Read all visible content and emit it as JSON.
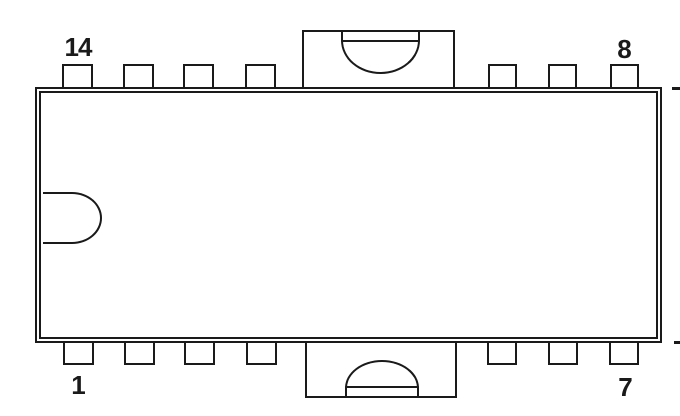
{
  "diagram": {
    "type": "ic-package-pinout",
    "description": "14-pin dual in-line package (DIP), top view",
    "pin_labels": {
      "top_left": "14",
      "top_right": "8",
      "bottom_left": "1",
      "bottom_right": "7"
    },
    "pins": {
      "top_row_count": 7,
      "bottom_row_count": 7,
      "total": 14
    },
    "features": [
      "double-line body outline",
      "D-shaped index notch on left inner wall",
      "top center mounting tab with downward semicircular cutout",
      "bottom center mounting tab with upward semicircular cutout",
      "tick dashes at right edge aligned with body top and bottom edges"
    ],
    "colors": {
      "line": "#1a1a1a",
      "background": "#ffffff"
    }
  }
}
